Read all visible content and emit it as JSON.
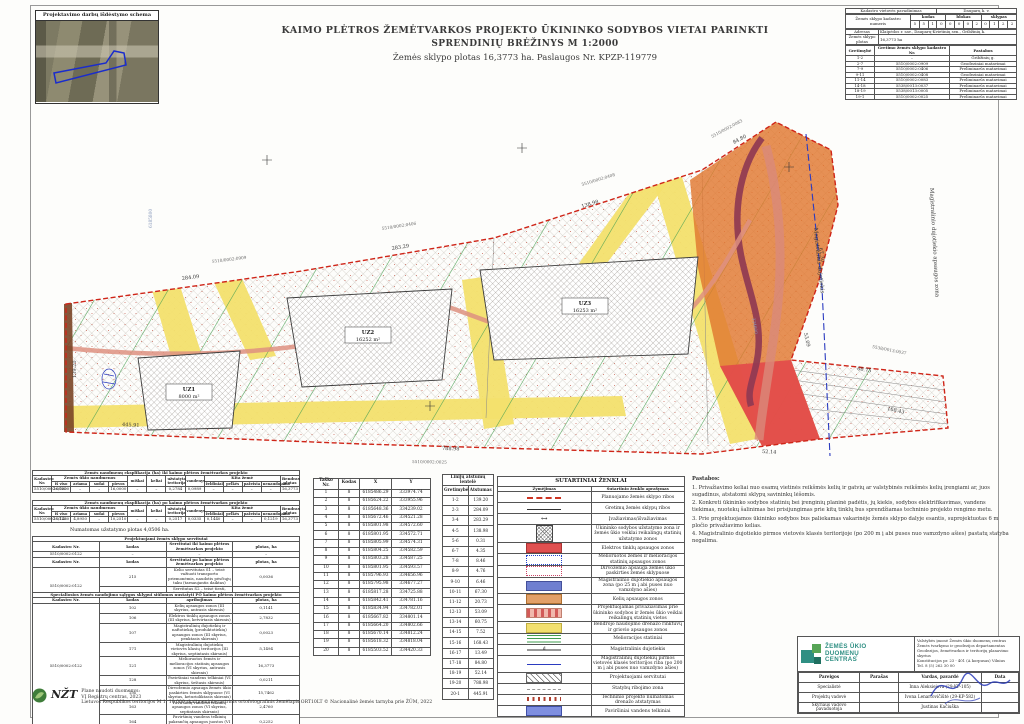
{
  "schema_box": {
    "title": "Projektavimo darbų išdėstymo schema"
  },
  "title_block": {
    "line1": "KAIMO PLĖTROS ŽEMĖTVARKOS PROJEKTO ŪKININKO SODYBOS VIETAI PARINKTI",
    "line2": "SPRENDINIŲ BRĖŽINYS M 1:2000",
    "line3": "Žemės sklypo plotas 16,3773 ha.  Paslaugos Nr. KPZP-119779"
  },
  "cad_info": {
    "vietove_label": "Kadastro vietovės pavadinimas",
    "vietove_value": "Dauparų k. v.",
    "kad_nr_label": "Žemės sklypo kadastro numeris",
    "kodas_label": "kodas",
    "blokas_label": "blokas",
    "sklypas_label": "sklypas",
    "digits": [
      "5",
      "5",
      "1",
      "0",
      "0",
      "0",
      "0",
      "2",
      "0",
      "1",
      "2",
      "2"
    ],
    "adresas_label": "Adresas",
    "adresas_value": "Klaipėdos r. sav., Dauparų-Kvietinių sen., Gribžinių k.",
    "plotas_label": "Žemės sklypo plotas",
    "plotas_value": "16,3773 ha",
    "neigh_headers": [
      "Gretimybė",
      "Gretimo žemės sklypo kadastro Nr.",
      "Pastabos"
    ],
    "neigh_rows": [
      [
        "1-2",
        "–",
        "Gribžinių g."
      ],
      [
        "2-7",
        "5510/0002:0909",
        "Geodeziniai matavimai"
      ],
      [
        "7-9",
        "5510/0002:0406",
        "Preliminarūs matavimai"
      ],
      [
        "9-11",
        "5510/0002:0408",
        "Geodeziniai matavimai"
      ],
      [
        "11-14",
        "5510/0002:0083",
        "Preliminarūs matavimai"
      ],
      [
        "14-18",
        "5538/0013:0037",
        "Preliminarūs matavimai"
      ],
      [
        "18-19",
        "5538/0013:0005",
        "Preliminarūs matavimai"
      ],
      [
        "19-1",
        "5510/0002:0025",
        "Preliminarūs matavimai"
      ]
    ]
  },
  "map": {
    "zones": [
      {
        "code": "UZ1",
        "area": "8000 m²"
      },
      {
        "code": "UZ2",
        "area": "16252 m²"
      },
      {
        "code": "UZ3",
        "area": "16253 m²"
      }
    ],
    "gas_line_label": "Magistralinis dujotiekis",
    "gas_zone_label": "Magistralinio dujotiekio apsaugos zona",
    "neighbors": [
      "5510/0002:0909",
      "5510/0002:0406",
      "5510/0002:0408",
      "5510/0002:0083",
      "5538/0013:0037",
      "5510/0002:0025"
    ],
    "dims": [
      "139.20",
      "284.09",
      "283.29",
      "138.98",
      "67.30",
      "53.09",
      "60.75",
      "168.43",
      "84.80",
      "52.14",
      "788.98",
      "445.91"
    ],
    "grid_labels": [
      "6185800",
      "334600"
    ]
  },
  "expl": {
    "labels": {
      "kad": "Kadastro Nr.",
      "zun": "Žemės ūkio naudmenos",
      "sub": [
        "iš viso",
        "ariama",
        "sodai",
        "pievos"
      ],
      "misc": [
        "miškai",
        "keliai",
        "užstatyta teritorija",
        "vandenys"
      ],
      "kita": "Kita žemė",
      "kita_sub": [
        "želdiniai",
        "pelkės",
        "pažeista",
        "nenaudojama"
      ],
      "bendras": "Bendras plotas"
    },
    "before": {
      "title": "Žemės naudmenų eksplikacija (ha) iki kaimo plėtros žemėtvarkos projekto",
      "rows": [
        [
          "5510/0002:0122",
          "16,0000",
          "–",
          "–",
          "16,0000",
          "–",
          "–",
          "0,2784",
          "0,0989",
          "–",
          "–",
          "–",
          "–",
          "16,3773"
        ]
      ]
    },
    "after": {
      "title": "Žemės naudmenų eksplikacija (ha) po kaimo plėtros žemėtvarkos projekto",
      "rows": [
        [
          "5510/0002:0122",
          "15,1460",
          "4,8950",
          "–",
          "10,2510",
          "–",
          "–",
          "0,2517",
          "0,0335",
          "0,1440",
          "–",
          "–",
          "0,1219",
          "16,3773"
        ]
      ]
    },
    "note": "Numatomas užstatymo plotas 4,0506 ha."
  },
  "servitutai": {
    "title": "Projektuojami žemės sklypo servitutai",
    "kad_label": "Kadastro Nr.",
    "kodas_label": "kodas",
    "iki_label": "Servitutai iki kaimo plėtros žemėtvarkos projekto",
    "plotas_label": "plotas, ha",
    "iki_rows": [
      [
        "5510/0002:0122",
        "–",
        "–",
        "–"
      ]
    ],
    "po_label": "Servitutai po kaimo plėtros žemėtvarkos projekto",
    "po_rows": [
      [
        {
          "t": "5510/0002:0122",
          "rs": 2
        },
        "215",
        "Kelio servitutas S1 – teisė važiuoti transporto priemonėmis, naudotis pėsčiųjų taku (tarnaujantis daiktas)",
        "0,0036"
      ],
      [
        "222",
        "Servitutas S2 – teisė tiesti, aptarnauti, naudoti požemines, antžemines komunikacijas (tarnaujantis daiktas)",
        "0,0036"
      ]
    ]
  },
  "special": {
    "title": "Specialiosios žemės naudojimo sąlygos sklypui siūlomos nustatyti PO kaimo plėtros žemėtvarkos projekto",
    "headers": [
      "Kadastro Nr.",
      "kodas",
      "apribojimas",
      "plotas, ha"
    ],
    "rows": [
      [
        {
          "t": "5510/0002:0122",
          "rs": 9
        },
        "102",
        "Kelių apsaugos zonos (III skyrius, antrasis skirsnis)",
        "0,1141"
      ],
      [
        "106",
        "Elektros tinklų apsaugos zonos (III skyrius, ketvirtasis skirsnis)",
        "2,7832"
      ],
      [
        "107",
        "Magistralinių dujotiekių ir naftotiekių (produktotiekių) apsaugos zonos (III skyrius, penktasis skirsnis)",
        "0,0023"
      ],
      [
        "171",
        "Magistralinių dujotiekių vietovės klasių teritorijos (III skyrius, septintasis skirsnis)",
        "5,1494"
      ],
      [
        "121",
        "Melioruotos žemės ir melioracijos statinių apsaugos zonos (VI skyrius, antrasis skirsnis)",
        "16,3773"
      ],
      [
        "128",
        "Paviršiniai vandens telkiniai (VI skyrius, šeštasis skirsnis)",
        "0,0211"
      ],
      [
        "152",
        "Dirvožemio apsauga žemės ūkio paskirties žemės sklypuose (VI skyrius, keturioliktasis skirsnis)",
        "15,7462"
      ],
      [
        "163",
        "Paviršinių vandens telkinių apsaugos zonos (VI skyrius, septintasis skirsnis)",
        "2,4760"
      ],
      [
        "164",
        "Paviršinių vandens telkinių pakrančių apsaugos juostos (VI skyrius, aštuntasis skirsnis)",
        "0,2252"
      ]
    ]
  },
  "coords": {
    "headers": [
      "Taško Nr.",
      "Kodas",
      "X",
      "Y"
    ],
    "rows": [
      [
        "1",
        "8",
        "6185486.29",
        "333974.74"
      ],
      [
        "2",
        "8",
        "6185624.22",
        "333955.96"
      ],
      [
        "3",
        "8",
        "6185648.36",
        "334239.02"
      ],
      [
        "4",
        "8",
        "6185672.46",
        "334521.28"
      ],
      [
        "5",
        "8",
        "6185801.98",
        "334572.60"
      ],
      [
        "6",
        "8",
        "6185801.95",
        "334572.71"
      ],
      [
        "7",
        "8",
        "6185805.99",
        "334574.31"
      ],
      [
        "8",
        "8",
        "6185804.25",
        "334582.59"
      ],
      [
        "9",
        "8",
        "6185803.28",
        "334587.25"
      ],
      [
        "10",
        "8",
        "6185801.95",
        "334593.57"
      ],
      [
        "11",
        "8",
        "6185796.93",
        "334656.96"
      ],
      [
        "12",
        "8",
        "6185795.98",
        "334677.27"
      ],
      [
        "13",
        "8",
        "6185817.28",
        "334725.88"
      ],
      [
        "14",
        "8",
        "6185842.41",
        "334781.16"
      ],
      [
        "15",
        "8",
        "6185834.94",
        "334782.01"
      ],
      [
        "16",
        "8",
        "6185667.82",
        "334801.14"
      ],
      [
        "17",
        "8",
        "6185664.20",
        "334802.66"
      ],
      [
        "18",
        "8",
        "6185670.14",
        "334812.24"
      ],
      [
        "19",
        "8",
        "6185618.32",
        "334818.04"
      ],
      [
        "20",
        "8",
        "6185503.52",
        "334420.33"
      ]
    ]
  },
  "dists": {
    "title": "Linijų atstumų lentelė",
    "headers": [
      "Gretimybė",
      "Atstumas"
    ],
    "rows": [
      [
        "1-2",
        "139.20"
      ],
      [
        "2-3",
        "284.09"
      ],
      [
        "3-4",
        "283.29"
      ],
      [
        "4-5",
        "138.98"
      ],
      [
        "5-6",
        "0.31"
      ],
      [
        "6-7",
        "4.35"
      ],
      [
        "7-8",
        "8.46"
      ],
      [
        "8-9",
        "4.76"
      ],
      [
        "9-10",
        "6.46"
      ],
      [
        "10-11",
        "67.30"
      ],
      [
        "11-12",
        "20.73"
      ],
      [
        "12-13",
        "53.09"
      ],
      [
        "13-14",
        "60.75"
      ],
      [
        "14-15",
        "7.52"
      ],
      [
        "15-16",
        "168.43"
      ],
      [
        "16-17",
        "13.49"
      ],
      [
        "17-18",
        "84.80"
      ],
      [
        "18-19",
        "52.14"
      ],
      [
        "19-20",
        "788.98"
      ],
      [
        "20-1",
        "445.91"
      ]
    ]
  },
  "legend": {
    "title": "SUTARTINIAI ŽENKLAI",
    "col1": "Žymėjimas",
    "col2": "Sutartinio ženklo aprašymas",
    "rows": [
      {
        "swatch": "dashed-red",
        "text": "Planuojamo žemės sklypo ribos"
      },
      {
        "swatch": "solid-line",
        "text": "Gretimų žemės sklypų ribos"
      },
      {
        "swatch": "arrow",
        "glyph": "↔",
        "text": "Įvažiavimas/išvažiavimas"
      },
      {
        "swatch": "hatch-blocks",
        "text": "Ūkininko sodybos užstatymo zona ir žemės ūkio veiklai reikalingų statinių užstatymo zonos"
      },
      {
        "swatch": "red-fill",
        "text": "Elektros tinklų apsaugos zonos"
      },
      {
        "swatch": "blue-dot",
        "text": "Melioruotos žemės ir melioracijos statinių apsaugos zonos"
      },
      {
        "swatch": "pink-dot",
        "text": "Dirvožemio apsauga žemės ūkio paskirties žemės sklypuose"
      },
      {
        "swatch": "blue-fill",
        "text": "Magistralinio dujotiekio apsaugos zona (po 25 m į abi puses nuo vamzdyno ašies)"
      },
      {
        "swatch": "orange-fill",
        "text": "Kelių apsaugos zonos"
      },
      {
        "swatch": "pink-el",
        "text": "Projektuojamas privažiavimas prie ūkininko sodybos ir žemės ūkio veiklai reikalingų statinių vietos"
      },
      {
        "swatch": "yellow-fill",
        "text": "Bendrojo naudojimo drenažo rinktuvų ir griovio apsaugos zonos"
      },
      {
        "swatch": "green-lines",
        "text": "Melioracijos statiniai"
      },
      {
        "swatch": "gas-line",
        "glyph": "d",
        "text": "Magistralinis dujotiekis"
      },
      {
        "swatch": "blue-line",
        "text": "Magistralinių dujotiekių pirmos vietovės klasės teritorijos riba (po 200 m į abi puses nuo vamzdyno ašies)"
      },
      {
        "swatch": "diag-hatch",
        "text": "Projektuojami servitutai"
      },
      {
        "swatch": "gray-dash",
        "text": "Statybų ribojimo zona"
      },
      {
        "swatch": "red-ticks",
        "text": "Techninio projekto numatomas drenažo atstatymas"
      },
      {
        "swatch": "water-fill",
        "text": "Paviršiniai vandens telkiniai"
      }
    ]
  },
  "notes": {
    "title": "Pastabos:",
    "items": [
      "1. Privažiavimo keliai nuo esamų vietinės reikšmės kelių ir gatvių ar valstybinės reikšmės kelių įrengiami ar, juos sugadinus, atstatomi sklypų savininkų lėšomis.",
      "2. Konkreti ūkininko sodybos statinių bei įrenginių planinė padėtis, jų kiekis, sodybos elektrifikavimas, vandens tiekimas, nuotekų šalinimas bei prisijungimas prie kitų tinklų bus sprendžiamas techninio projekto rengimo metu.",
      "3. Prie projektuojamos ūkininko sodybos bus paliekamas vakarinėje žemės sklypo dalyje esantis, suprojektuotas 6 m pločio privažiavimo kelias.",
      "4. Magistralinio dujotiekio pirmos vietovės klasės teritorijoje (po 200 m į abi puses nuo vamzdyno ašies) pastatų statyba negalima."
    ]
  },
  "nzt": {
    "abbr": "NŽT",
    "line1": "Plane naudoti duomenys:",
    "line2": "VĮ Registrų centras, 2023",
    "line3": "Lietuvos Respublikos teritorijos M 1: 10 000 skaitmeninis rastrinis ortofotografinis žemėlapis ORT10LT © Nacionalinė žemės tarnyba prie ŽŪM, 2022"
  },
  "org": {
    "name_lines": [
      "ŽEMĖS ŪKIO",
      "DUOMENŲ",
      "CENTRAS"
    ],
    "addr_lines": [
      "Valstybės įmonė Žemės ūkio duomenų centras",
      "Žemės tvarkymo ir geodezijos departamentas",
      "Geodezijos, žemėtvarkos ir teritorijų planavimo skyrius",
      "Konstitucijos pr. 23 - 401 (A korpusas) Vilnius",
      "Tel. 8 (5) 262 30 00"
    ],
    "headers": [
      "Pareigos",
      "Parašas",
      "Vardas, pavardė",
      "Data"
    ],
    "rows": [
      [
        "Specialistė",
        "",
        "Inna Aleksiejeva (29-KP-105)",
        ""
      ],
      [
        "Projektų vadovė",
        "",
        "Ivona Lenartovičiūtė (29-KP-582)",
        ""
      ],
      [
        "Skyriaus vadovo pavaduotoja",
        "",
        "Justinas Kačiuška",
        ""
      ]
    ]
  }
}
